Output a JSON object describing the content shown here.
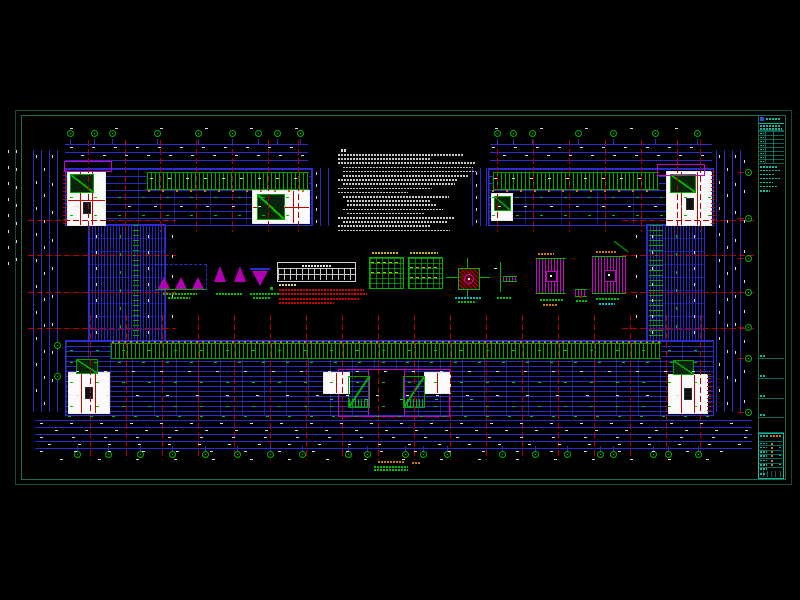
{
  "app": {
    "type": "cad-structural-floor-plan",
    "background": "#000000",
    "text_rendering_note": "all annotation text in source screenshot is sub-3px and illegible; represented as micro-text bars"
  },
  "colors": {
    "white": "#dcdcdc",
    "green": "#00c000",
    "red": "#d00000",
    "orange": "#c87814",
    "yellow": "#c8b414",
    "cyan": "#00c0c0",
    "magenta": "#c800c8",
    "blue": "#2a2ace",
    "paleyellow": "#d8d890",
    "teal": "#14b89e",
    "sheet_border": "#134c40"
  },
  "axis_bubbles": {
    "top_y": 133,
    "top_left_x": [
      70,
      94,
      112,
      157,
      198,
      232,
      258,
      277,
      300
    ],
    "top_right_x": [
      497,
      513,
      532,
      578,
      613,
      655,
      697
    ],
    "bottom_y": 454,
    "bottom_x": [
      77,
      108,
      140,
      172,
      205,
      237,
      270,
      302,
      348,
      367,
      405,
      423,
      447,
      502,
      535,
      567,
      600,
      613,
      653,
      668,
      698
    ],
    "right_x": 748,
    "right_y": [
      172,
      218,
      258,
      292,
      327,
      358,
      412
    ],
    "left_x": 57,
    "left_y": [
      345,
      376
    ]
  },
  "grid": {
    "red_vert_top_left": [
      88,
      125,
      160,
      196,
      232,
      268,
      298
    ],
    "red_vert_top_right": [
      497,
      533,
      569,
      605,
      641,
      677,
      700
    ],
    "red_vert_top_span": [
      140,
      232
    ],
    "red_vert_bottom": [
      90,
      126,
      162,
      198,
      234,
      270,
      306,
      342,
      378,
      414,
      450,
      486,
      522,
      558,
      594,
      630,
      666,
      700
    ],
    "red_vert_bottom_span": [
      315,
      460
    ],
    "red_horiz_wing_y": [
      220,
      255,
      292,
      328
    ],
    "red_horiz_left_x": [
      28,
      176
    ],
    "red_horiz_right_x": [
      622,
      755
    ]
  },
  "dim_lines": [
    {
      "t": "h",
      "x": 65,
      "y": 144,
      "len": 243
    },
    {
      "t": "h",
      "x": 65,
      "y": 152,
      "len": 243
    },
    {
      "t": "h",
      "x": 65,
      "y": 160,
      "len": 243
    },
    {
      "t": "h",
      "x": 490,
      "y": 144,
      "len": 222
    },
    {
      "t": "h",
      "x": 490,
      "y": 152,
      "len": 222
    },
    {
      "t": "h",
      "x": 490,
      "y": 160,
      "len": 222
    },
    {
      "t": "v",
      "x": 33,
      "y": 150,
      "len": 262
    },
    {
      "t": "v",
      "x": 41,
      "y": 150,
      "len": 262
    },
    {
      "t": "v",
      "x": 49,
      "y": 150,
      "len": 262
    },
    {
      "t": "v",
      "x": 57,
      "y": 150,
      "len": 262
    },
    {
      "t": "v",
      "x": 716,
      "y": 150,
      "len": 262
    },
    {
      "t": "v",
      "x": 724,
      "y": 150,
      "len": 262
    },
    {
      "t": "v",
      "x": 732,
      "y": 150,
      "len": 262
    },
    {
      "t": "v",
      "x": 740,
      "y": 150,
      "len": 262
    },
    {
      "t": "h",
      "x": 35,
      "y": 420,
      "len": 717
    },
    {
      "t": "h",
      "x": 35,
      "y": 427,
      "len": 717
    },
    {
      "t": "h",
      "x": 35,
      "y": 434,
      "len": 717
    },
    {
      "t": "h",
      "x": 35,
      "y": 441,
      "len": 717
    },
    {
      "t": "h",
      "x": 35,
      "y": 448,
      "len": 717
    },
    {
      "t": "v",
      "x": 312,
      "y": 168,
      "len": 58
    },
    {
      "t": "v",
      "x": 320,
      "y": 168,
      "len": 58
    },
    {
      "t": "v",
      "x": 328,
      "y": 168,
      "len": 58
    },
    {
      "t": "v",
      "x": 472,
      "y": 168,
      "len": 58
    },
    {
      "t": "v",
      "x": 480,
      "y": 168,
      "len": 58
    },
    {
      "t": "v",
      "x": 486,
      "y": 168,
      "len": 58
    }
  ],
  "specks": [
    {
      "t": "r",
      "y": 128,
      "x": 70,
      "len": 238,
      "step": 45,
      "c": "white"
    },
    {
      "t": "r",
      "y": 128,
      "x": 495,
      "len": 208,
      "step": 45,
      "c": "white"
    },
    {
      "t": "r",
      "y": 147,
      "x": 70,
      "len": 236,
      "step": 22,
      "c": "white"
    },
    {
      "t": "r",
      "y": 155,
      "x": 81,
      "len": 225,
      "step": 22,
      "c": "white"
    },
    {
      "t": "r",
      "y": 147,
      "x": 492,
      "len": 214,
      "step": 22,
      "c": "white"
    },
    {
      "t": "r",
      "y": 155,
      "x": 503,
      "len": 203,
      "step": 22,
      "c": "white"
    },
    {
      "t": "r",
      "y": 178,
      "x": 150,
      "len": 156,
      "step": 18,
      "c": "white"
    },
    {
      "t": "r",
      "y": 190,
      "x": 148,
      "len": 158,
      "step": 14,
      "c": "orange"
    },
    {
      "t": "r",
      "y": 197,
      "x": 70,
      "len": 236,
      "step": 24,
      "c": "green"
    },
    {
      "t": "r",
      "y": 206,
      "x": 76,
      "len": 230,
      "step": 26,
      "c": "white"
    },
    {
      "t": "r",
      "y": 215,
      "x": 70,
      "len": 236,
      "step": 24,
      "c": "green"
    },
    {
      "t": "r",
      "y": 178,
      "x": 494,
      "len": 160,
      "step": 18,
      "c": "white"
    },
    {
      "t": "r",
      "y": 190,
      "x": 492,
      "len": 164,
      "step": 14,
      "c": "orange"
    },
    {
      "t": "r",
      "y": 197,
      "x": 492,
      "len": 216,
      "step": 24,
      "c": "green"
    },
    {
      "t": "r",
      "y": 206,
      "x": 498,
      "len": 210,
      "step": 26,
      "c": "white"
    },
    {
      "t": "r",
      "y": 215,
      "x": 492,
      "len": 216,
      "step": 24,
      "c": "green"
    },
    {
      "t": "r",
      "y": 341,
      "x": 112,
      "len": 546,
      "step": 6,
      "c": "orange"
    },
    {
      "t": "r",
      "y": 350,
      "x": 70,
      "len": 638,
      "step": 26,
      "c": "green"
    },
    {
      "t": "r",
      "y": 362,
      "x": 70,
      "len": 638,
      "step": 24,
      "c": "green"
    },
    {
      "t": "r",
      "y": 371,
      "x": 76,
      "len": 632,
      "step": 28,
      "c": "white"
    },
    {
      "t": "r",
      "y": 382,
      "x": 70,
      "len": 638,
      "step": 26,
      "c": "green"
    },
    {
      "t": "r",
      "y": 395,
      "x": 76,
      "len": 632,
      "step": 30,
      "c": "white"
    },
    {
      "t": "r",
      "y": 399,
      "x": 330,
      "len": 140,
      "step": 35,
      "c": "cyan"
    },
    {
      "t": "r",
      "y": 406,
      "x": 70,
      "len": 638,
      "step": 26,
      "c": "green"
    },
    {
      "t": "r",
      "y": 416,
      "x": 68,
      "len": 642,
      "step": 22,
      "c": "green"
    },
    {
      "t": "r",
      "y": 423,
      "x": 40,
      "len": 710,
      "step": 30,
      "c": "white"
    },
    {
      "t": "r",
      "y": 430,
      "x": 55,
      "len": 695,
      "step": 30,
      "c": "white"
    },
    {
      "t": "r",
      "y": 437,
      "x": 40,
      "len": 710,
      "step": 32,
      "c": "white"
    },
    {
      "t": "r",
      "y": 444,
      "x": 48,
      "len": 702,
      "step": 30,
      "c": "white"
    },
    {
      "t": "r",
      "y": 451,
      "x": 40,
      "len": 710,
      "step": 34,
      "c": "white"
    },
    {
      "t": "r",
      "y": 459,
      "x": 60,
      "len": 650,
      "step": 38,
      "c": "white"
    },
    {
      "t": "r",
      "y": 262,
      "x": 371,
      "len": 28,
      "step": 6,
      "c": "yellow"
    },
    {
      "t": "r",
      "y": 272,
      "x": 371,
      "len": 28,
      "step": 6,
      "c": "yellow"
    },
    {
      "t": "r",
      "y": 267,
      "x": 410,
      "len": 28,
      "step": 6,
      "c": "yellow"
    },
    {
      "t": "r",
      "y": 277,
      "x": 410,
      "len": 28,
      "step": 6,
      "c": "yellow"
    },
    {
      "t": "c",
      "x": 36,
      "y": 155,
      "len": 250,
      "step": 26,
      "c": "white"
    },
    {
      "t": "c",
      "x": 44,
      "y": 168,
      "len": 237,
      "step": 26,
      "c": "white"
    },
    {
      "t": "c",
      "x": 52,
      "y": 155,
      "len": 250,
      "step": 28,
      "c": "white"
    },
    {
      "t": "c",
      "x": 8,
      "y": 150,
      "len": 112,
      "step": 16,
      "c": "white"
    },
    {
      "t": "c",
      "x": 16,
      "y": 150,
      "len": 112,
      "step": 18,
      "c": "white"
    },
    {
      "t": "c",
      "x": 719,
      "y": 155,
      "len": 250,
      "step": 26,
      "c": "white"
    },
    {
      "t": "c",
      "x": 727,
      "y": 168,
      "len": 237,
      "step": 26,
      "c": "white"
    },
    {
      "t": "c",
      "x": 735,
      "y": 155,
      "len": 250,
      "step": 28,
      "c": "white"
    },
    {
      "t": "c",
      "x": 744,
      "y": 160,
      "len": 240,
      "step": 30,
      "c": "white"
    },
    {
      "t": "c",
      "x": 96,
      "y": 235,
      "len": 98,
      "step": 16,
      "c": "white"
    },
    {
      "t": "c",
      "x": 120,
      "y": 235,
      "len": 98,
      "step": 18,
      "c": "green"
    },
    {
      "t": "c",
      "x": 148,
      "y": 235,
      "len": 98,
      "step": 16,
      "c": "white"
    },
    {
      "t": "c",
      "x": 172,
      "y": 235,
      "len": 98,
      "step": 20,
      "c": "white"
    },
    {
      "t": "c",
      "x": 316,
      "y": 172,
      "len": 48,
      "step": 12,
      "c": "white"
    },
    {
      "t": "c",
      "x": 476,
      "y": 172,
      "len": 48,
      "step": 12,
      "c": "white"
    },
    {
      "t": "c",
      "x": 652,
      "y": 235,
      "len": 98,
      "step": 16,
      "c": "white"
    },
    {
      "t": "c",
      "x": 676,
      "y": 235,
      "len": 98,
      "step": 18,
      "c": "green"
    },
    {
      "t": "c",
      "x": 694,
      "y": 235,
      "len": 98,
      "step": 16,
      "c": "white"
    },
    {
      "t": "c",
      "x": 636,
      "y": 235,
      "len": 98,
      "step": 20,
      "c": "white"
    }
  ],
  "notes": {
    "title": {
      "x": 341,
      "y": 149,
      "w": 5,
      "c": "white"
    },
    "x": 338,
    "y0": 154,
    "lh": 4.2,
    "lines": [
      {
        "ind": 0,
        "w": 126
      },
      {
        "ind": 0,
        "w": 92
      },
      {
        "ind": 0,
        "w": 138
      },
      {
        "ind": 5,
        "w": 130
      },
      {
        "ind": 5,
        "w": 133
      },
      {
        "ind": 5,
        "w": 126
      },
      {
        "ind": 0,
        "w": 120
      },
      {
        "ind": 5,
        "w": 112
      },
      {
        "ind": 0,
        "w": 94
      },
      {
        "ind": 0,
        "w": 70
      },
      {
        "ind": 5,
        "w": 106
      },
      {
        "ind": 9,
        "w": 84
      },
      {
        "ind": 9,
        "w": 90
      },
      {
        "ind": 5,
        "w": 100
      },
      {
        "ind": 9,
        "w": 78
      },
      {
        "ind": 0,
        "w": 116
      },
      {
        "ind": 5,
        "w": 104
      },
      {
        "ind": 0,
        "w": 92
      },
      {
        "ind": 0,
        "w": 112
      }
    ]
  },
  "labels": [
    {
      "x": 163,
      "y": 293,
      "w": 34,
      "c": "green"
    },
    {
      "x": 168,
      "y": 297,
      "w": 22,
      "c": "green"
    },
    {
      "x": 216,
      "y": 293,
      "w": 26,
      "c": "green"
    },
    {
      "x": 250,
      "y": 293,
      "w": 30,
      "c": "green"
    },
    {
      "x": 253,
      "y": 297,
      "w": 18,
      "c": "green"
    },
    {
      "x": 279,
      "y": 284,
      "w": 18,
      "c": "paleyellow"
    },
    {
      "x": 279,
      "y": 288.5,
      "w": 85,
      "c": "red"
    },
    {
      "x": 279,
      "y": 293,
      "w": 88,
      "c": "red"
    },
    {
      "x": 279,
      "y": 297.5,
      "w": 80,
      "c": "red"
    },
    {
      "x": 279,
      "y": 302,
      "w": 55,
      "c": "red"
    },
    {
      "x": 372,
      "y": 252,
      "w": 26,
      "c": "yellow"
    },
    {
      "x": 410,
      "y": 252,
      "w": 28,
      "c": "yellow"
    },
    {
      "x": 455,
      "y": 297,
      "w": 26,
      "c": "cyan"
    },
    {
      "x": 458,
      "y": 301,
      "w": 18,
      "c": "green"
    },
    {
      "x": 497,
      "y": 297,
      "w": 14,
      "c": "green"
    },
    {
      "x": 538,
      "y": 253,
      "w": 16,
      "c": "orange"
    },
    {
      "x": 540,
      "y": 299,
      "w": 24,
      "c": "green"
    },
    {
      "x": 543,
      "y": 303.5,
      "w": 14,
      "c": "orange"
    },
    {
      "x": 596,
      "y": 251,
      "w": 20,
      "c": "orange"
    },
    {
      "x": 596,
      "y": 298,
      "w": 24,
      "c": "green"
    },
    {
      "x": 599,
      "y": 302.5,
      "w": 16,
      "c": "cyan"
    },
    {
      "x": 576,
      "y": 300,
      "w": 12,
      "c": "green"
    },
    {
      "x": 378,
      "y": 461,
      "w": 26,
      "c": "orange"
    },
    {
      "x": 374,
      "y": 466,
      "w": 34,
      "c": "green"
    },
    {
      "x": 374,
      "y": 468.5,
      "w": 34,
      "c": "green"
    },
    {
      "x": 412,
      "y": 462,
      "w": 9,
      "c": "orange"
    }
  ],
  "title_block": {
    "x": 758,
    "w": 26,
    "accent": "#14b89e",
    "accent_dim": "rgba(20,184,158,0.55)",
    "orange": "#c87c14",
    "blue_icon": "#2a4fd0",
    "header_y": 117,
    "table": {
      "y": 131,
      "rows": 8,
      "row_h": 4
    },
    "text_line_widths": [
      18,
      20,
      15,
      20,
      13,
      17
    ],
    "text_lines_y": 166,
    "mid_lines_y": [
      358,
      378,
      398,
      417,
      432
    ],
    "bottom": {
      "y": 433,
      "h": 44,
      "rows": 7
    }
  }
}
